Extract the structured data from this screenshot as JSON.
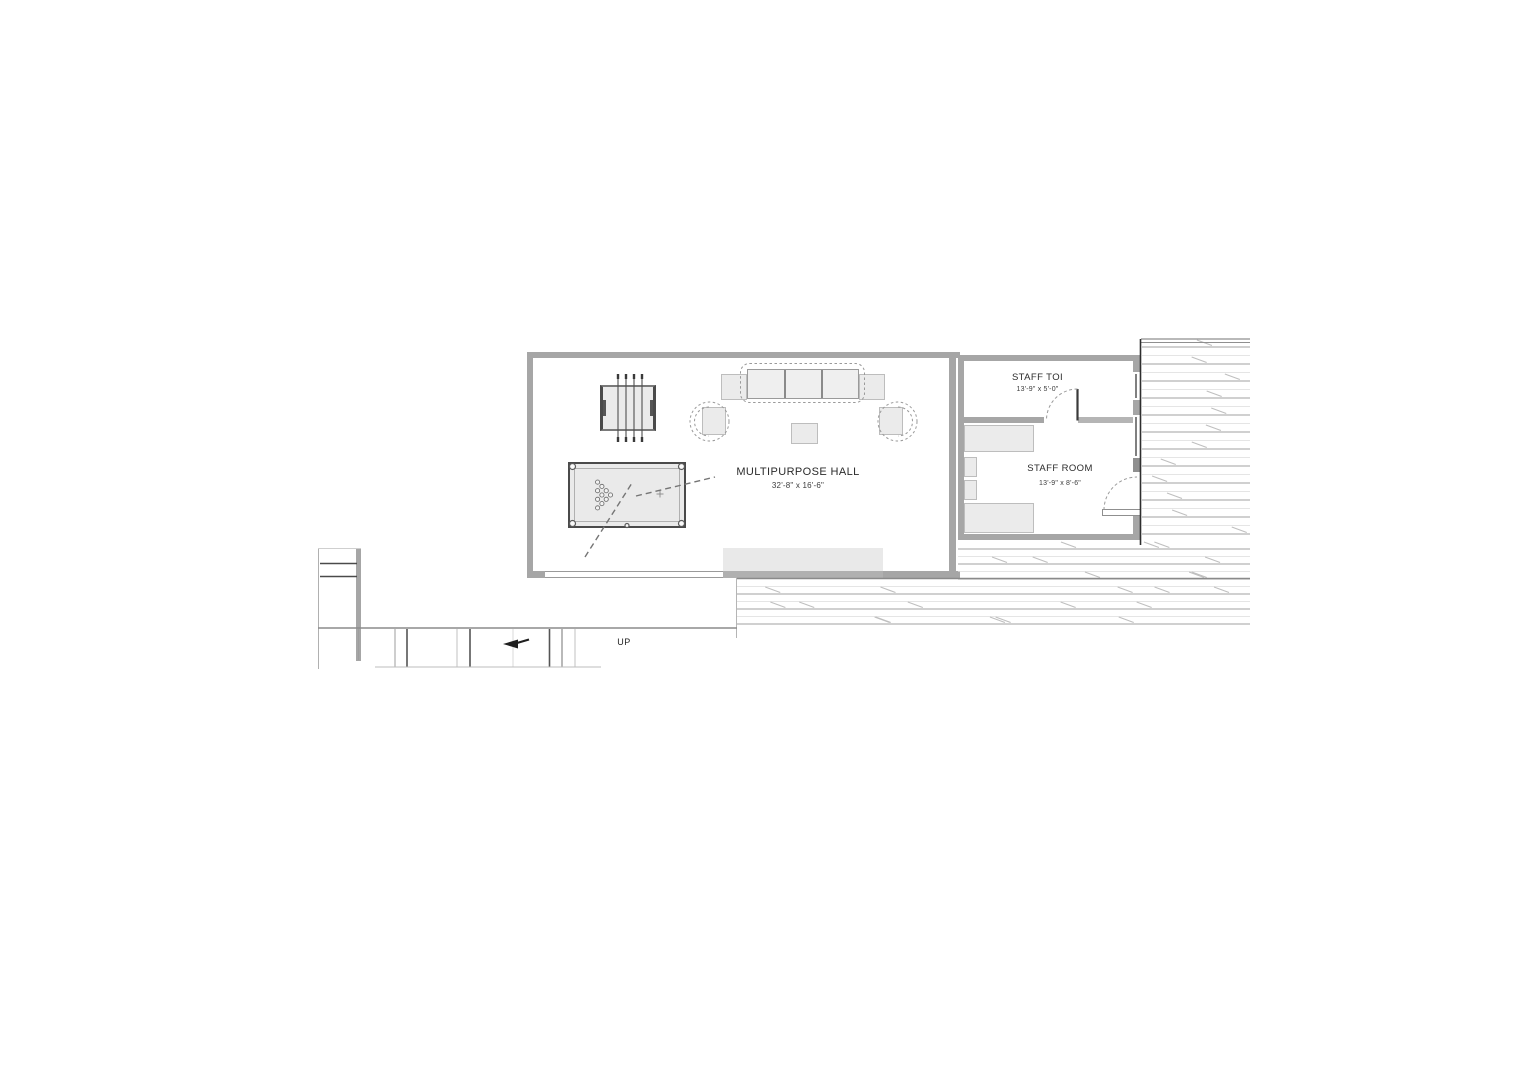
{
  "rooms": {
    "hall": {
      "name": "MULTIPURPOSE HALL",
      "dims": "32'-8\" x 16'-6\""
    },
    "staff_toilet": {
      "name": "STAFF TOI",
      "dims": "13'-9\" x 5'-0\""
    },
    "staff_room": {
      "name": "STAFF ROOM",
      "dims": "13'-9\" x 8'-6\""
    }
  },
  "stairs": {
    "direction": "UP"
  },
  "furniture": {
    "hall": [
      "foosball-table",
      "pool-table",
      "sofa",
      "armchair-left",
      "armchair-right",
      "side-table-left",
      "side-table-right",
      "coffee-table"
    ],
    "staff_room": [
      "counter-top",
      "shelf-upper",
      "shelf-lower",
      "counter-bottom"
    ]
  },
  "colors": {
    "wall": "#a6a6a6",
    "furniture_fill": "#ebebeb",
    "roof_hatch_dark": "#a2a2a2",
    "roof_hatch_light": "#dcdcdc",
    "line": "#8a8a8a"
  }
}
